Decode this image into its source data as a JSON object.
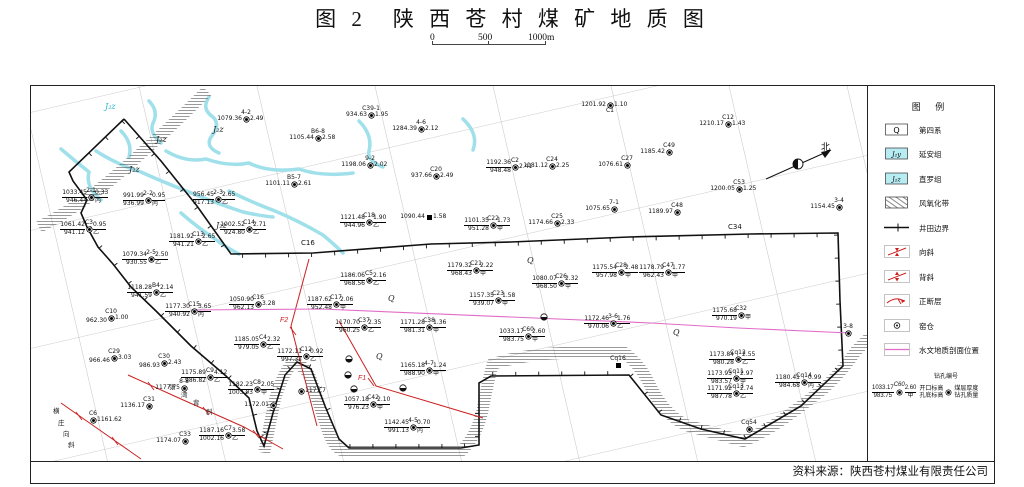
{
  "title": "图 2　陕 西 苍 村 煤 矿 地 质 图",
  "scale_bar": {
    "labels": [
      "0",
      "500",
      "1000m"
    ]
  },
  "source": "资料来源：陕西苍村煤业有限责任公司",
  "north_label": "北",
  "colors": {
    "river": "#9fe0ea",
    "strata_cyan": "#b7ecf3",
    "fault_red": "#cc2020",
    "section_pink": "#e06cc8",
    "boundary_black": "#111111",
    "grid_gray": "#999999"
  },
  "legend": {
    "title": "图 例",
    "items": [
      {
        "type": "qbox",
        "sym": "Q",
        "label": "第四系"
      },
      {
        "type": "cyanbox",
        "sym": "J₂y",
        "label": "延安组"
      },
      {
        "type": "cyanbox",
        "sym": "J₂z",
        "label": "直罗组"
      },
      {
        "type": "hatch",
        "sym": "",
        "label": "风氧化带"
      },
      {
        "type": "boundary",
        "sym": "",
        "label": "井田边界"
      },
      {
        "type": "syncline",
        "sym": "",
        "label": "向斜"
      },
      {
        "type": "anticline",
        "sym": "",
        "label": "背斜"
      },
      {
        "type": "fault",
        "sym": "",
        "label": "正断层"
      },
      {
        "type": "kiln",
        "sym": "",
        "label": "窑仓"
      },
      {
        "type": "section",
        "sym": "",
        "label": "水文地质剖面位置"
      }
    ],
    "drill_example": {
      "id": "C60",
      "top": "1033.17",
      "bottom": "983.75",
      "thick": "2.60",
      "grade": "甲",
      "lbl_id": "钻孔编号",
      "lbl_top": "开口标高",
      "lbl_bottom": "孔底标高",
      "lbl_thick": "煤层厚度",
      "lbl_quality": "钻孔质量"
    }
  },
  "map": {
    "strata_labels": [
      {
        "t": "J₂z",
        "x": 104,
        "y": 108,
        "c": "#2ab5c9"
      },
      {
        "t": "J₂z",
        "x": 155,
        "y": 141
      },
      {
        "t": "J₂z",
        "x": 212,
        "y": 131
      },
      {
        "t": "J₂z",
        "x": 128,
        "y": 171
      },
      {
        "t": "J₂z",
        "x": 215,
        "y": 227
      },
      {
        "t": "Q",
        "x": 387,
        "y": 300
      },
      {
        "t": "Q",
        "x": 526,
        "y": 262
      },
      {
        "t": "Q",
        "x": 672,
        "y": 334
      },
      {
        "t": "Q",
        "x": 375,
        "y": 358
      }
    ],
    "point_labels": [
      {
        "t": "C16",
        "x": 300,
        "y": 244
      },
      {
        "t": "C34",
        "x": 727,
        "y": 228
      }
    ],
    "fault_labels": [
      {
        "t": "F2",
        "x": 279,
        "y": 321
      },
      {
        "t": "F1",
        "x": 357,
        "y": 379
      }
    ],
    "fold_names": [
      {
        "chars": [
          {
            "t": "张",
            "x": 168,
            "y": 388
          },
          {
            "t": "湾",
            "x": 180,
            "y": 396
          },
          {
            "t": "背",
            "x": 192,
            "y": 404
          },
          {
            "t": "斜",
            "x": 205,
            "y": 413
          }
        ]
      },
      {
        "chars": [
          {
            "t": "横",
            "x": 52,
            "y": 412
          },
          {
            "t": "庄",
            "x": 57,
            "y": 424
          },
          {
            "t": "向",
            "x": 62,
            "y": 435
          },
          {
            "t": "斜",
            "x": 67,
            "y": 446
          }
        ]
      }
    ],
    "drills": [
      {
        "id": "4-2",
        "x": 245,
        "y": 118,
        "tl": "1079.36",
        "tr": "2.49"
      },
      {
        "id": "C39-1",
        "x": 370,
        "y": 114,
        "tl": "934.63",
        "tr": "1.95"
      },
      {
        "id": "B6-8",
        "x": 317,
        "y": 137,
        "tl": "1105.44",
        "tr": "2.58"
      },
      {
        "id": "4-6",
        "x": 420,
        "y": 128,
        "tl": "1284.39",
        "tr": "2.12"
      },
      {
        "id": "9-2",
        "x": 369,
        "y": 164,
        "tl": "1198.06",
        "tr": "2.02"
      },
      {
        "id": "C20",
        "x": 435,
        "y": 175,
        "tl": "937.66",
        "tr": "2.49"
      },
      {
        "id": "B5-7",
        "x": 293,
        "y": 183,
        "tl": "1101.11",
        "tr": "2.61"
      },
      {
        "id": "C1",
        "x": 609,
        "y": 104,
        "tl": "1201.92",
        "tr": "1.10",
        "idpos": "below"
      },
      {
        "id": "C12",
        "x": 727,
        "y": 123,
        "tl": "1210.17",
        "tr": "1.43"
      },
      {
        "id": "C49",
        "x": 668,
        "y": 151,
        "tl": "1185.42"
      },
      {
        "id": "C27",
        "x": 626,
        "y": 164,
        "tl": "1076.61"
      },
      {
        "id": "C24",
        "x": 551,
        "y": 165,
        "tl": "1181.12",
        "tr": "2.25"
      },
      {
        "id": "C53",
        "x": 738,
        "y": 188,
        "tl": "1200.05",
        "tr": "1.25"
      },
      {
        "id": "C2",
        "x": 514,
        "y": 166,
        "tl": "1192.36",
        "bl": "948.48",
        "tr": "2.41"
      },
      {
        "id": "7-1",
        "x": 613,
        "y": 208,
        "tl": "1075.65"
      },
      {
        "id": "C48",
        "x": 676,
        "y": 211,
        "tl": "1189.97"
      },
      {
        "id": "3-4",
        "x": 838,
        "y": 206,
        "tl": "1154.45"
      },
      {
        "id": "C25",
        "x": 556,
        "y": 222,
        "tl": "1174.66",
        "tr": "2.33"
      },
      {
        "id": "C22",
        "x": 492,
        "y": 224,
        "tl": "1101.35",
        "bl": "951.28",
        "tr": "1.73",
        "br": "甲"
      },
      {
        "id": "C18",
        "x": 368,
        "y": 221,
        "tl": "1121.48",
        "bl": "944.96",
        "tr": "1.90",
        "br": "乙"
      },
      {
        "id": "",
        "x": 428,
        "y": 216,
        "tl": "1090.44",
        "tr": "1.58",
        "sym": "sq"
      },
      {
        "id": "2-1",
        "x": 90,
        "y": 196,
        "tl": "1033.45",
        "bl": "946.44",
        "tr": "0.33",
        "br": "丙"
      },
      {
        "id": "2-2",
        "x": 147,
        "y": 199,
        "tl": "991.99",
        "bl": "936.99",
        "tr": "0.95",
        "br": "丙"
      },
      {
        "id": "2-3",
        "x": 217,
        "y": 198,
        "tl": "956.45",
        "bl": "917.13",
        "tr": "2.65",
        "br": "乙"
      },
      {
        "id": "C3",
        "x": 88,
        "y": 228,
        "tl": "1061.42",
        "bl": "941.12",
        "tr": "0.95",
        "br": "乙"
      },
      {
        "id": "C14",
        "x": 248,
        "y": 228,
        "tl": "1002.52",
        "bl": "924.80",
        "tr": "2.71",
        "br": "乙"
      },
      {
        "id": "C13",
        "x": 197,
        "y": 240,
        "tl": "1181.92",
        "bl": "941.21",
        "tr": "2.65",
        "br": "乙"
      },
      {
        "id": "2-5",
        "x": 150,
        "y": 258,
        "tl": "1079.34",
        "bl": "930.55",
        "tr": "2.50",
        "br": "乙"
      },
      {
        "id": "B4",
        "x": 155,
        "y": 291,
        "tl": "1118.28",
        "bl": "941.59",
        "tr": "2.14",
        "br": "乙"
      },
      {
        "id": "C10",
        "x": 110,
        "y": 317,
        "bl": "962.30",
        "tr": "1.00"
      },
      {
        "id": "C15",
        "x": 193,
        "y": 310,
        "tl": "1177.30",
        "bl": "940.92",
        "tr": "3.65",
        "br": "丙"
      },
      {
        "id": "C16",
        "x": 257,
        "y": 303,
        "tl": "1050.90",
        "bl": "962.13",
        "tr": "3.28"
      },
      {
        "id": "C5",
        "x": 368,
        "y": 279,
        "tl": "1186.06",
        "bl": "968.56",
        "tr": "2.16",
        "br": "乙"
      },
      {
        "id": "C21",
        "x": 475,
        "y": 269,
        "tl": "1179.32",
        "bl": "968.43",
        "tr": "2.22",
        "br": "甲"
      },
      {
        "id": "C17",
        "x": 335,
        "y": 303,
        "tl": "1187.62",
        "bl": "952.48",
        "tr": "2.06",
        "br": "甲"
      },
      {
        "id": "C23",
        "x": 497,
        "y": 299,
        "tl": "1157.35",
        "bl": "939.07",
        "tr": "1.58",
        "br": "甲"
      },
      {
        "id": "C28",
        "x": 620,
        "y": 271,
        "tl": "1175.54",
        "bl": "957.98",
        "tr": "2.48",
        "br": "甲"
      },
      {
        "id": "C47",
        "x": 667,
        "y": 271,
        "tl": "1178.79",
        "bl": "962.43",
        "tr": "1.77",
        "br": "甲"
      },
      {
        "id": "C26",
        "x": 560,
        "y": 282,
        "tl": "1080.07",
        "bl": "968.50",
        "tr": "2.32",
        "br": "甲"
      },
      {
        "id": "C37",
        "x": 363,
        "y": 326,
        "tl": "1170.70",
        "bl": "960.25",
        "tr": "2.35",
        "br": "乙"
      },
      {
        "id": "C38",
        "x": 428,
        "y": 326,
        "tl": "1171.28",
        "bl": "981.31",
        "tr": "1.36",
        "br": "甲"
      },
      {
        "id": "3-6",
        "x": 612,
        "y": 322,
        "tl": "1172.46",
        "bl": "970.06",
        "tr": "1.76",
        "br": "乙"
      },
      {
        "id": "C60",
        "x": 527,
        "y": 335,
        "tl": "1033.17",
        "bl": "983.75",
        "tr": "2.60",
        "br": "甲"
      },
      {
        "id": "C32",
        "x": 740,
        "y": 314,
        "tl": "1175.68",
        "bl": "970.19",
        "br": "甲"
      },
      {
        "id": "Cq12",
        "x": 737,
        "y": 358,
        "tl": "1173.84",
        "bl": "980.28",
        "tr": "2.55",
        "br": "乙"
      },
      {
        "id": "Cq11",
        "x": 735,
        "y": 377,
        "tl": "1173.93",
        "bl": "983.57",
        "tr": "2.97",
        "br": "甲"
      },
      {
        "id": "Cq13",
        "x": 735,
        "y": 392,
        "tl": "1171.92",
        "bl": "987.78",
        "tr": "2.74",
        "br": "乙"
      },
      {
        "id": "Cq14",
        "x": 803,
        "y": 381,
        "tl": "1180.41",
        "bl": "984.68",
        "tr": "0.99",
        "br": "丙"
      },
      {
        "id": "Cq54",
        "x": 748,
        "y": 428
      },
      {
        "id": "3-8",
        "x": 847,
        "y": 332
      },
      {
        "id": "C4",
        "x": 262,
        "y": 343,
        "tl": "1185.05",
        "bl": "979.05",
        "tr": "2.32",
        "br": "乙"
      },
      {
        "id": "C8",
        "x": 256,
        "y": 388,
        "tl": "1182.23",
        "bl": "1003.03",
        "tr": "2.05",
        "br": "甲"
      },
      {
        "id": "C29",
        "x": 113,
        "y": 357,
        "bl": "966.46",
        "tr": "3.03"
      },
      {
        "id": "C30",
        "x": 163,
        "y": 362,
        "bl": "986.93",
        "tr": "2.43"
      },
      {
        "id": "C9",
        "x": 209,
        "y": 376,
        "tl": "1175.89",
        "bl": "986.82",
        "tr": "4.12",
        "br": "乙"
      },
      {
        "id": "8-8",
        "x": 183,
        "y": 387,
        "tl": "1177.75"
      },
      {
        "id": "C31",
        "x": 148,
        "y": 405,
        "tl": "1136.17"
      },
      {
        "id": "C6",
        "x": 92,
        "y": 419,
        "tr": "1161.62"
      },
      {
        "id": "C33",
        "x": 184,
        "y": 440,
        "tl": "1174.07"
      },
      {
        "id": "C7",
        "x": 227,
        "y": 434,
        "tl": "1187.16",
        "bl": "1002.16",
        "tr": "3.58",
        "br": "乙"
      },
      {
        "id": "C12",
        "x": 305,
        "y": 355,
        "tl": "1172.11",
        "bl": "997.32",
        "tr": "0.92",
        "br": "乙"
      },
      {
        "id": "",
        "x": 300,
        "y": 390,
        "tr": "1171.7"
      },
      {
        "id": "",
        "x": 272,
        "y": 404,
        "tl": "1172.01"
      },
      {
        "id": "4-7",
        "x": 428,
        "y": 369,
        "tl": "1165.18",
        "bl": "988.90",
        "tr": "1.24",
        "br": "甲"
      },
      {
        "id": "C42",
        "x": 372,
        "y": 403,
        "tl": "1057.18",
        "bl": "976.23",
        "tr": "2.10",
        "br": "甲"
      },
      {
        "id": "4-5",
        "x": 412,
        "y": 426,
        "tl": "1142.45",
        "bl": "991.13",
        "tr": "0.70",
        "br": "丙"
      },
      {
        "id": "Cq16",
        "x": 617,
        "y": 364,
        "sym": "sq"
      }
    ],
    "kiln_symbols": [
      [
        348,
        358
      ],
      [
        347,
        374
      ],
      [
        353,
        388
      ],
      [
        402,
        387
      ],
      [
        543,
        316
      ]
    ]
  }
}
